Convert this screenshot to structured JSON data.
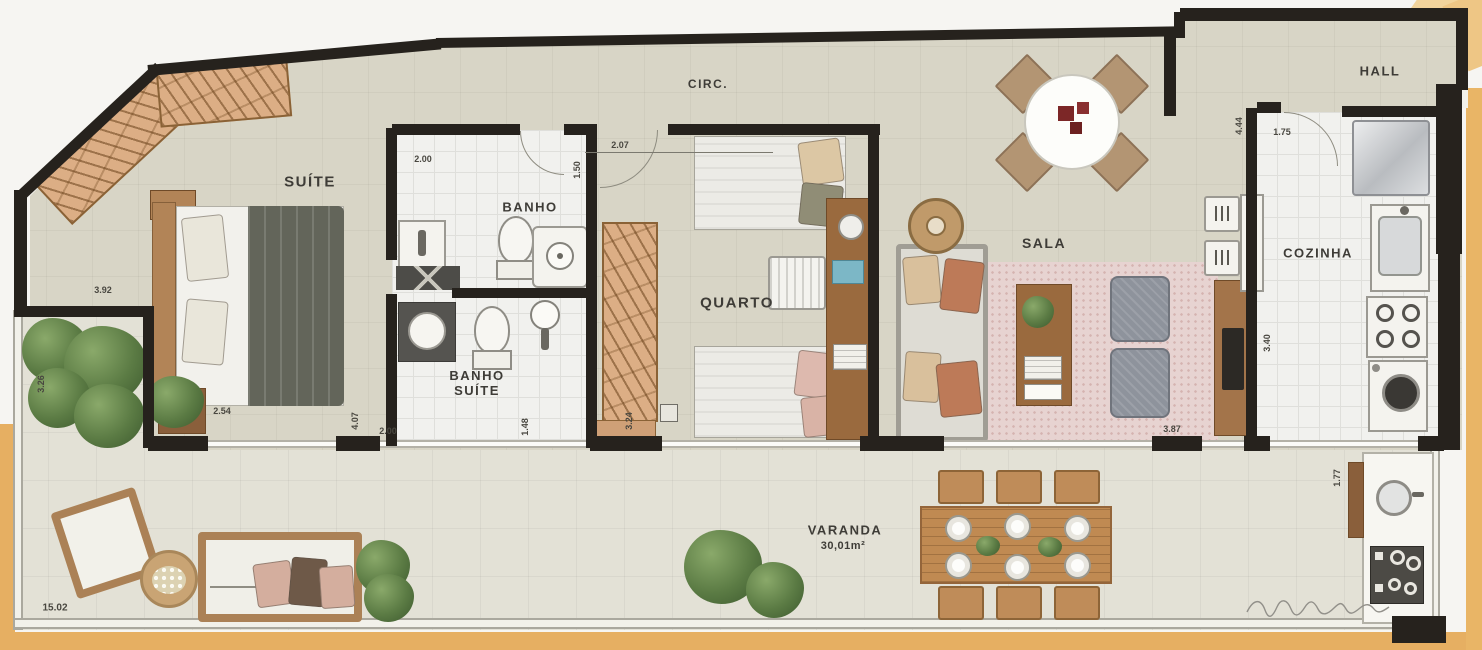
{
  "plan": {
    "rooms": [
      {
        "id": "suite",
        "label": "SUÍTE"
      },
      {
        "id": "banho",
        "label": "BANHO"
      },
      {
        "id": "banho-suite",
        "label": "BANHO SUÍTE"
      },
      {
        "id": "circ",
        "label": "CIRC."
      },
      {
        "id": "quarto",
        "label": "QUARTO"
      },
      {
        "id": "sala",
        "label": "SALA"
      },
      {
        "id": "hall",
        "label": "HALL"
      },
      {
        "id": "cozinha",
        "label": "COZINHA"
      },
      {
        "id": "varanda",
        "label": "VARANDA",
        "area": "30,01m²"
      }
    ],
    "dimensions": {
      "banho_width": "2.00",
      "banho_depth": "1.50",
      "circ_width": "2.07",
      "suite_width": "3.92",
      "varanda_side_depth": "3.26",
      "suite_bed_width": "2.54",
      "suite_depth": "4.07",
      "banho_suite_width": "2.00",
      "banho_suite_depth": "1.48",
      "quarto_depth": "3.24",
      "sala_width": "3.87",
      "cozinha_depth": "3.40",
      "hall_cozinha_depth": "4.44",
      "cozinha_width": "1.75",
      "varanda_right_depth": "1.77",
      "varanda_length": "15.02"
    }
  }
}
